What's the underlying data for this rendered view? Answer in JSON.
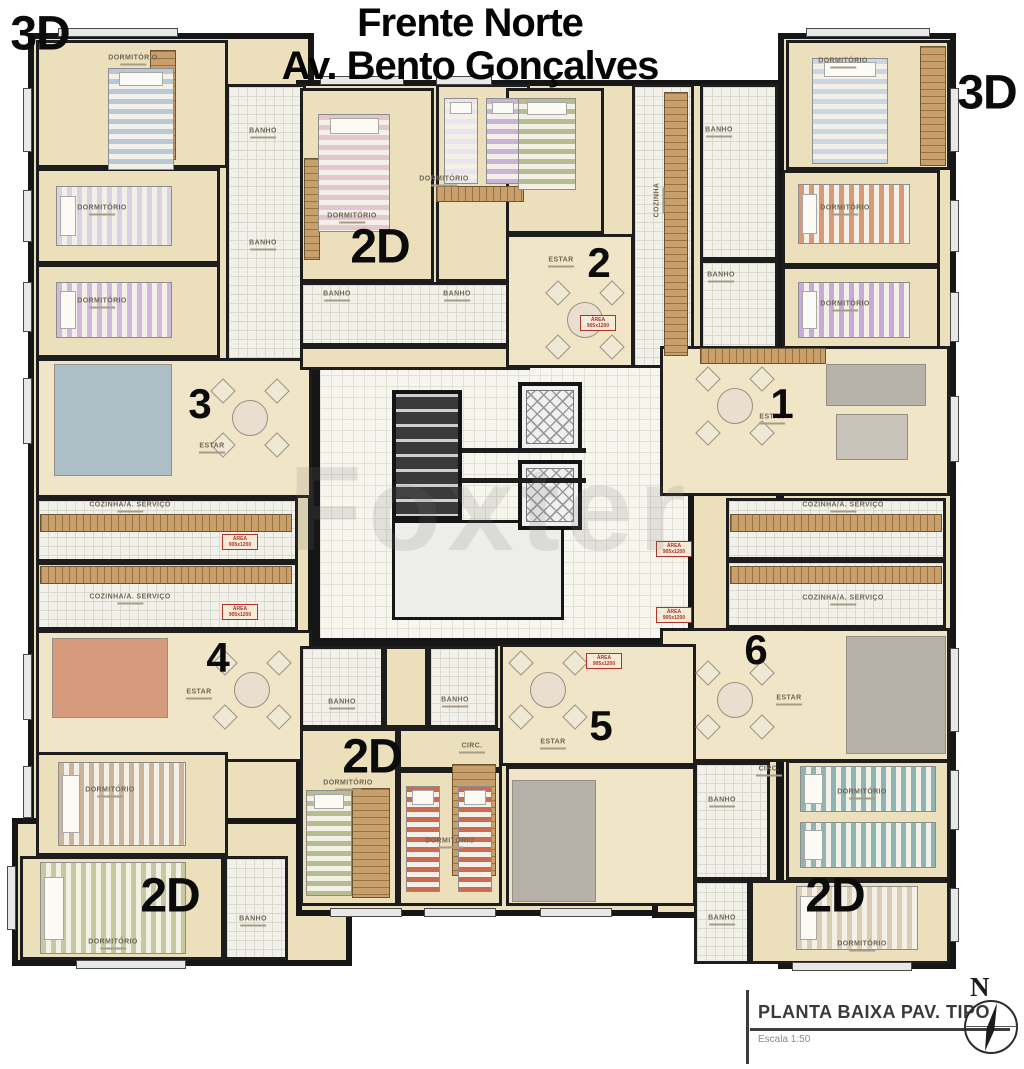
{
  "title": {
    "line1": "Frente Norte",
    "line2": "Av. Bento Gonçalves"
  },
  "legend": {
    "plan_title": "PLANTA BAIXA PAV. TIPO",
    "plan_scale": "Escala 1:50"
  },
  "compass_label": "N",
  "watermark_text": "Foxter",
  "colors": {
    "wall": "#161616",
    "room_floor": "#ebdfbc",
    "living_floor": "#f0e5c6",
    "tile_floor": "#f1f1ea",
    "hall_floor": "#f6f5ee",
    "tag_red": "#b03327"
  },
  "unit_type_labels": [
    {
      "text": "3D",
      "x": 40,
      "y": 34
    },
    {
      "text": "3D",
      "x": 987,
      "y": 93
    },
    {
      "text": "2D",
      "x": 380,
      "y": 247
    },
    {
      "text": "2D",
      "x": 372,
      "y": 757
    },
    {
      "text": "2D",
      "x": 170,
      "y": 896
    },
    {
      "text": "2D",
      "x": 835,
      "y": 896
    }
  ],
  "unit_numbers": [
    {
      "text": "1",
      "x": 782,
      "y": 404
    },
    {
      "text": "2",
      "x": 599,
      "y": 263
    },
    {
      "text": "3",
      "x": 200,
      "y": 404
    },
    {
      "text": "4",
      "x": 218,
      "y": 658
    },
    {
      "text": "5",
      "x": 601,
      "y": 726
    },
    {
      "text": "6",
      "x": 756,
      "y": 650
    }
  ],
  "room_labels": [
    {
      "text": "DORMITÓRIO",
      "x": 133,
      "y": 60
    },
    {
      "text": "DORMITÓRIO",
      "x": 102,
      "y": 210
    },
    {
      "text": "DORMITÓRIO",
      "x": 102,
      "y": 303
    },
    {
      "text": "BANHO",
      "x": 263,
      "y": 133
    },
    {
      "text": "BANHO",
      "x": 263,
      "y": 245
    },
    {
      "text": "ESTAR",
      "x": 212,
      "y": 448
    },
    {
      "text": "COZINHA/A. SERVIÇO",
      "x": 130,
      "y": 507
    },
    {
      "text": "COZINHA/A. SERVIÇO",
      "x": 130,
      "y": 599
    },
    {
      "text": "ESTAR",
      "x": 199,
      "y": 694
    },
    {
      "text": "DORMITÓRIO",
      "x": 110,
      "y": 792
    },
    {
      "text": "DORMITÓRIO",
      "x": 113,
      "y": 944
    },
    {
      "text": "BANHO",
      "x": 253,
      "y": 921
    },
    {
      "text": "DORMITÓRIO",
      "x": 352,
      "y": 218
    },
    {
      "text": "DORMITÓRIO",
      "x": 444,
      "y": 181
    },
    {
      "text": "BANHO",
      "x": 337,
      "y": 296
    },
    {
      "text": "BANHO",
      "x": 457,
      "y": 296
    },
    {
      "text": "ESTAR",
      "x": 561,
      "y": 262
    },
    {
      "text": "COZINHA",
      "x": 659,
      "y": 200,
      "vertical": true
    },
    {
      "text": "BANHO",
      "x": 719,
      "y": 132
    },
    {
      "text": "BANHO",
      "x": 721,
      "y": 277
    },
    {
      "text": "DORMITÓRIO",
      "x": 843,
      "y": 63
    },
    {
      "text": "DORMITÓRIO",
      "x": 845,
      "y": 210
    },
    {
      "text": "DORMITÓRIO",
      "x": 845,
      "y": 306
    },
    {
      "text": "ESTAR",
      "x": 772,
      "y": 419
    },
    {
      "text": "COZINHA/A. SERVIÇO",
      "x": 843,
      "y": 507
    },
    {
      "text": "COZINHA/A. SERVIÇO",
      "x": 843,
      "y": 600
    },
    {
      "text": "ESTAR",
      "x": 789,
      "y": 700
    },
    {
      "text": "CIRC.",
      "x": 769,
      "y": 771
    },
    {
      "text": "BANHO",
      "x": 722,
      "y": 802
    },
    {
      "text": "DORMITÓRIO",
      "x": 862,
      "y": 794
    },
    {
      "text": "BANHO",
      "x": 722,
      "y": 920
    },
    {
      "text": "DORMITÓRIO",
      "x": 862,
      "y": 946
    },
    {
      "text": "BANHO",
      "x": 342,
      "y": 704
    },
    {
      "text": "BANHO",
      "x": 455,
      "y": 702
    },
    {
      "text": "CIRC.",
      "x": 472,
      "y": 748
    },
    {
      "text": "ESTAR",
      "x": 553,
      "y": 744
    },
    {
      "text": "DORMITÓRIO",
      "x": 348,
      "y": 785
    },
    {
      "text": "DORMITÓRIO",
      "x": 450,
      "y": 843
    }
  ],
  "door_tags": [
    {
      "line1": "ÁREA",
      "line2": "905x1200",
      "x": 598,
      "y": 322
    },
    {
      "line1": "ÁREA",
      "line2": "905x1200",
      "x": 240,
      "y": 541
    },
    {
      "line1": "ÁREA",
      "line2": "905x1200",
      "x": 240,
      "y": 611
    },
    {
      "line1": "ÁREA",
      "line2": "905x1200",
      "x": 674,
      "y": 548
    },
    {
      "line1": "ÁREA",
      "line2": "905x1200",
      "x": 674,
      "y": 614
    },
    {
      "line1": "ÁREA",
      "line2": "905x1200",
      "x": 604,
      "y": 660
    }
  ]
}
